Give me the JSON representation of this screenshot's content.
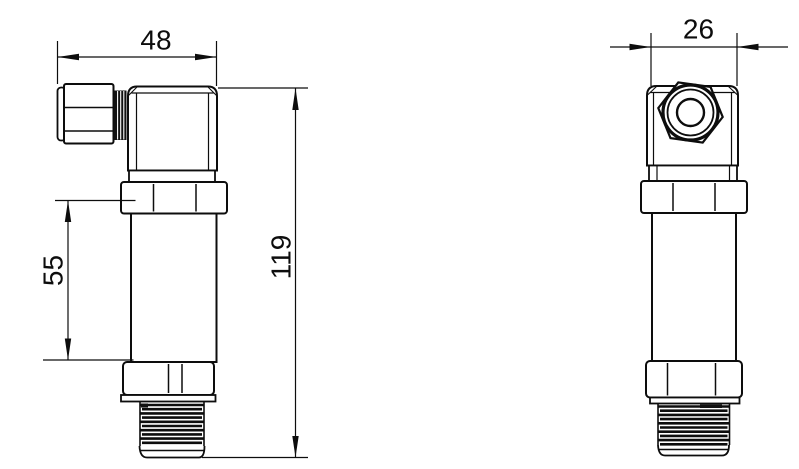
{
  "drawing": {
    "type": "technical-dimension-drawing",
    "views": {
      "side_view": {
        "name": "side-view"
      },
      "front_view": {
        "name": "front-view"
      }
    },
    "dimensions": {
      "side_width": "48",
      "front_width": "26",
      "overall_height": "119",
      "upper_body_height": "55"
    },
    "colors": {
      "line": "#0d0d0d",
      "background": "#ffffff"
    }
  }
}
